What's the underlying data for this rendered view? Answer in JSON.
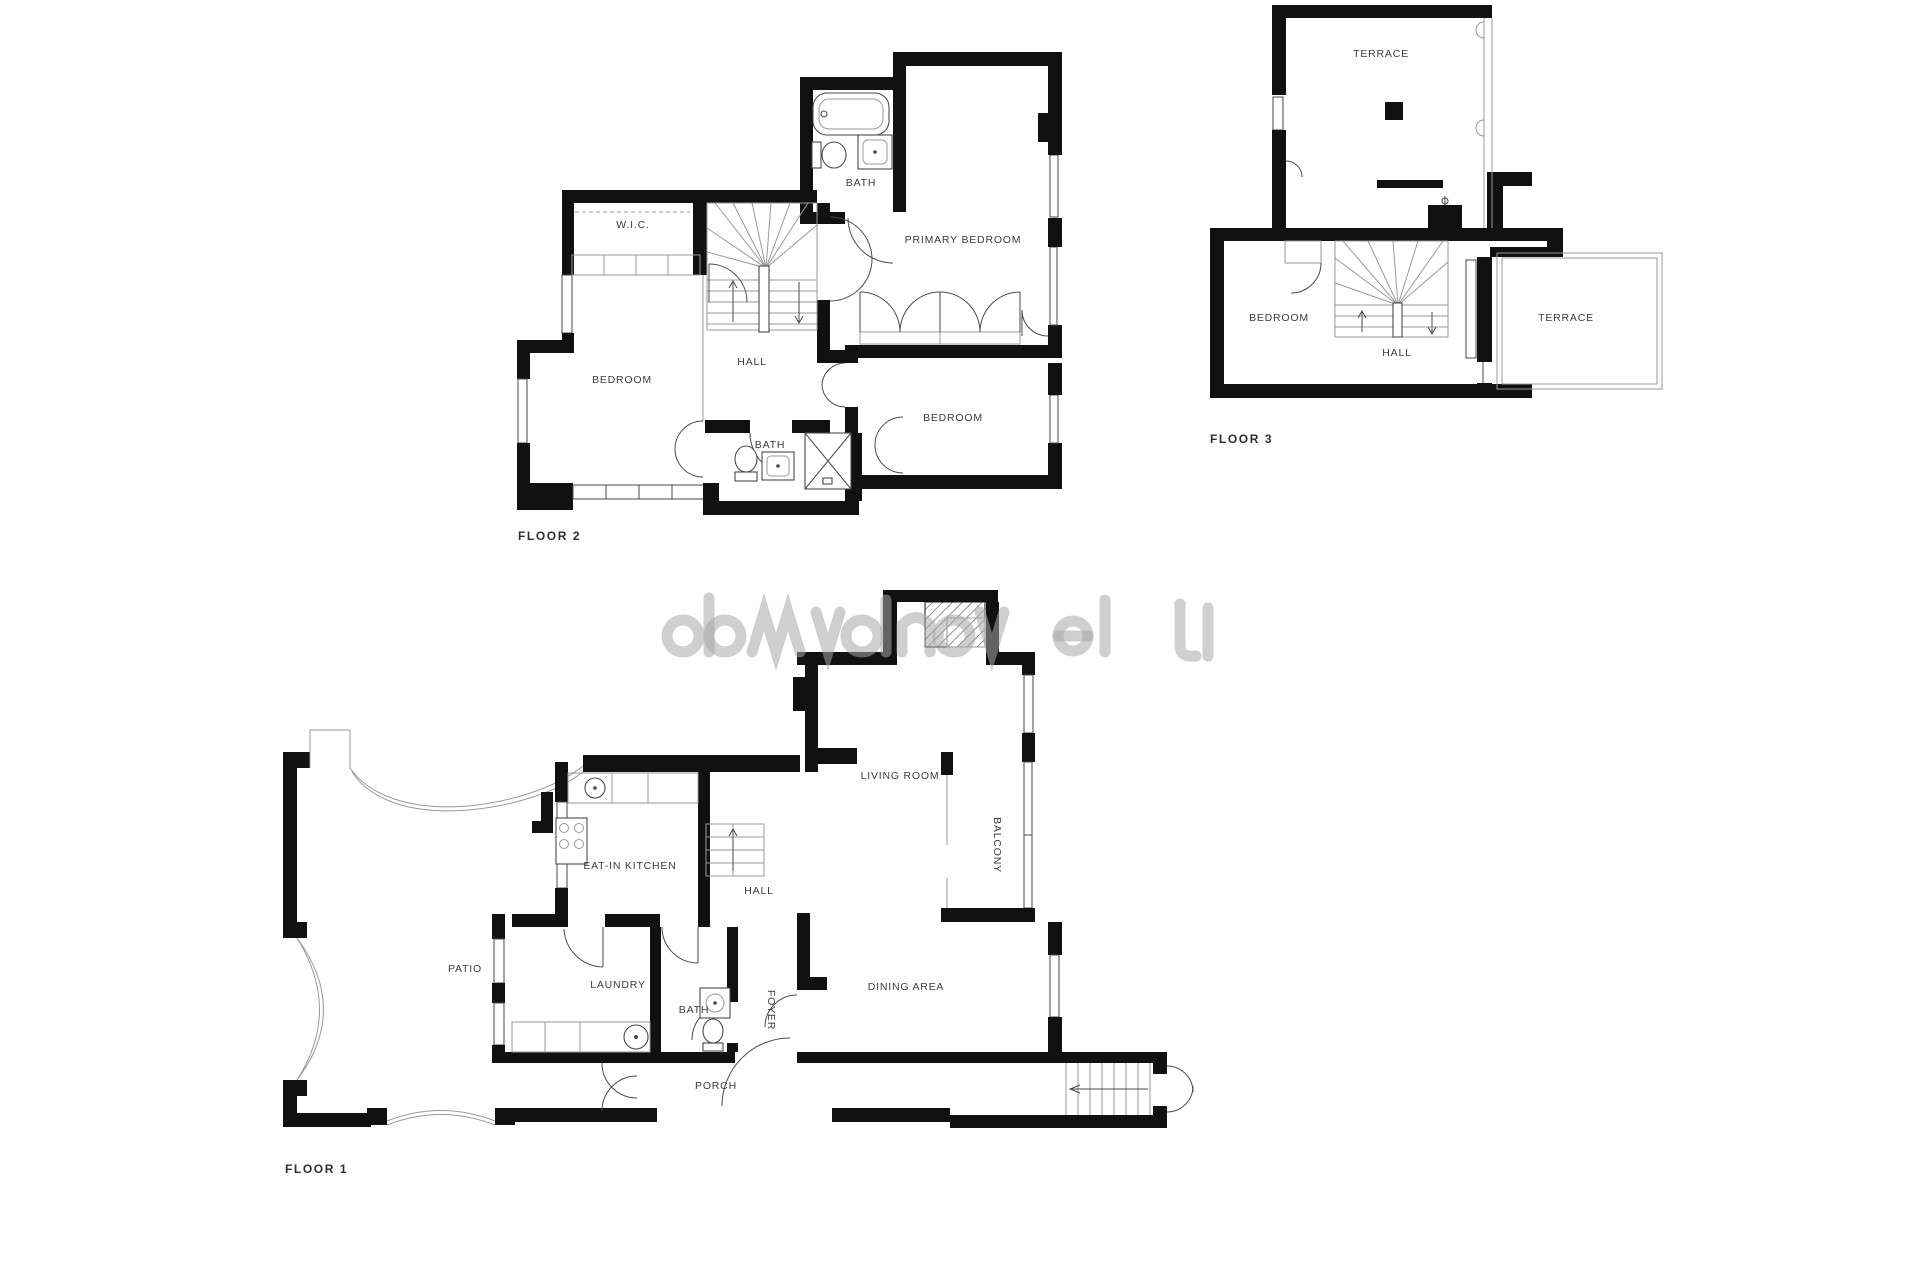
{
  "document": {
    "background": "#ffffff"
  },
  "colors": {
    "wall": "#111111",
    "line": "#4a4a4a",
    "thin": "#999999",
    "label": "#3c3c3c",
    "floor_label": "#2e2e2e",
    "watermark": "#a8a8a8"
  },
  "floor1": {
    "label": "FLOOR 1",
    "rooms": {
      "patio": "PATIO",
      "kitchen": "EAT-IN KITCHEN",
      "hall": "HALL",
      "living": "LIVING ROOM",
      "balcony": "BALCONY",
      "laundry": "LAUNDRY",
      "bath": "BATH",
      "foyer": "FOYER",
      "dining": "DINING AREA",
      "porch": "PORCH"
    }
  },
  "floor2": {
    "label": "FLOOR 2",
    "rooms": {
      "wic": "W.I.C.",
      "bath_top": "BATH",
      "primary": "PRIMARY BEDROOM",
      "bedroom_left": "BEDROOM",
      "hall": "HALL",
      "bath_bottom": "BATH",
      "bedroom_right": "BEDROOM"
    }
  },
  "floor3": {
    "label": "FLOOR 3",
    "rooms": {
      "terrace_top": "TERRACE",
      "bedroom": "BEDROOM",
      "hall": "HALL",
      "terrace_side": "TERRACE"
    }
  }
}
